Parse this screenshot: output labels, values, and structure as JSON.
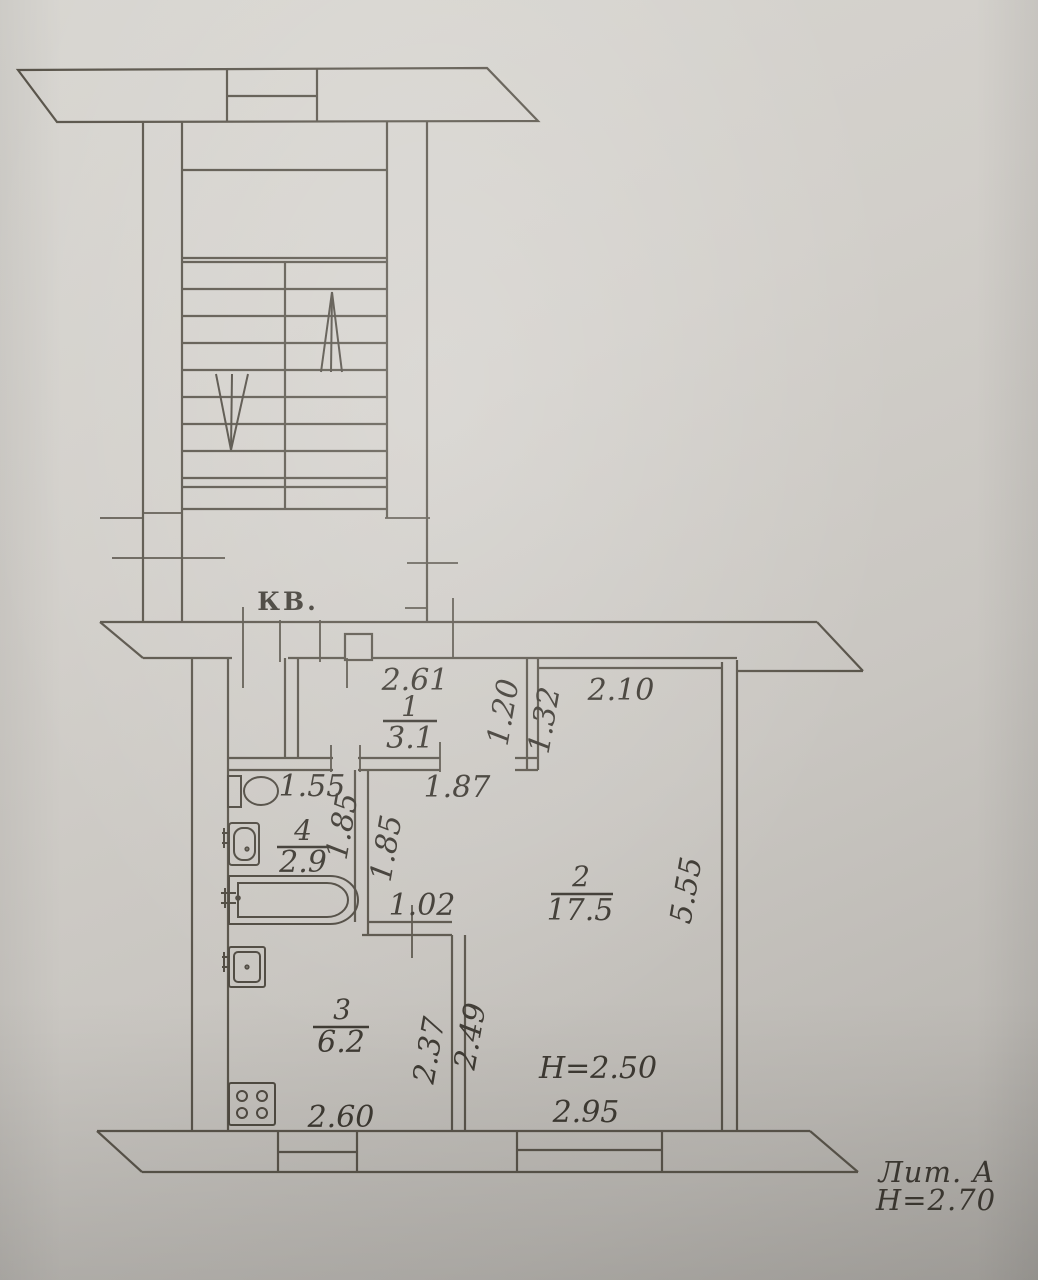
{
  "plan": {
    "apartment_label": "КВ.",
    "litera_label": "Лит.  А",
    "building_height_label": "Н=2.70",
    "room2_height_label": "Н=2.50",
    "rooms": [
      {
        "number": "1",
        "area": "3.1"
      },
      {
        "number": "2",
        "area": "17.5"
      },
      {
        "number": "3",
        "area": "6.2"
      },
      {
        "number": "4",
        "area": "2.9"
      }
    ],
    "dims": {
      "d261": "2.61",
      "d120": "1.20",
      "d132": "1.32",
      "d210": "2.10",
      "d155": "1.55",
      "d187": "1.87",
      "d185a": "1.85",
      "d185b": "1.85",
      "d102": "1.02",
      "d555": "5.55",
      "d237": "2.37",
      "d249": "2.49",
      "d260": "2.60",
      "d295": "2.95"
    }
  }
}
